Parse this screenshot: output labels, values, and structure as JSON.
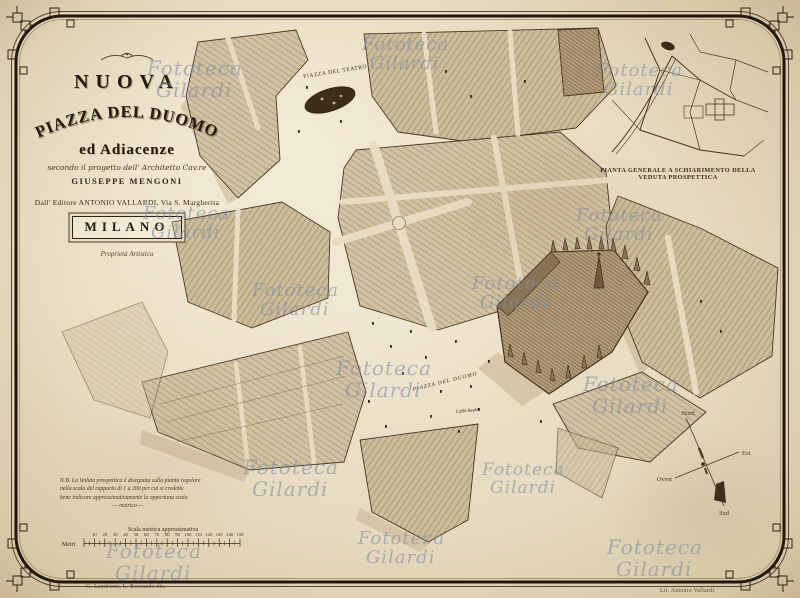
{
  "title_block": {
    "title_top": "NUOVA",
    "title_arc": "PIAZZA DEL DUOMO",
    "subtitle": "ed Adiacenze",
    "project_line": "secondo il progetto dell' Architetto Cav.re",
    "architect": "GIUSEPPE MENGONI",
    "publisher_line": "Dall' Editore ANTONIO VALLARDI, Via S. Margherita",
    "city": "MILANO",
    "rights": "Proprietà Artistica"
  },
  "inset": {
    "caption": "PIANTA GENERALE A SCHIARIMENTO DELLA VEDUTA PROSPETTICA"
  },
  "map_labels": {
    "piazza_teatro": "PIAZZA DEL TEATRO",
    "piazza_duomo": "PIAZZA DEL DUOMO",
    "caffe_reale": "Caffè Reale"
  },
  "note": {
    "lines": [
      "N.B. La Veduta prospettica è disegnata sulla pianta regolare",
      "nella scala del rapporto di 1 a 200 per cui si credette",
      "bene indicare approssimativamente la opportuna scala",
      "— metrica —"
    ]
  },
  "scale_bar": {
    "caption": "Scala metrica approssimativa",
    "unit": "Metri",
    "tick_labels": [
      "10",
      "20",
      "30",
      "40",
      "50",
      "60",
      "70",
      "80",
      "90",
      "100",
      "110",
      "120",
      "130",
      "140",
      "150"
    ]
  },
  "compass": {
    "n": "Nord",
    "e": "Est",
    "w": "Ovest",
    "s": "Sud"
  },
  "credits": {
    "drawn_by": "G. Landriani, L. Boccardo dis.",
    "lithographer": "Lit. Antonio Vallardi"
  },
  "watermark": {
    "line1": "Fototeca",
    "line2": "Gilardi",
    "color": "#7b8ea8",
    "positions": [
      {
        "x": 147,
        "y": 58,
        "fs": 20
      },
      {
        "x": 362,
        "y": 35,
        "fs": 18
      },
      {
        "x": 596,
        "y": 61,
        "fs": 18
      },
      {
        "x": 143,
        "y": 204,
        "fs": 18
      },
      {
        "x": 252,
        "y": 281,
        "fs": 18
      },
      {
        "x": 472,
        "y": 274,
        "fs": 18
      },
      {
        "x": 576,
        "y": 206,
        "fs": 18
      },
      {
        "x": 336,
        "y": 358,
        "fs": 20
      },
      {
        "x": 583,
        "y": 374,
        "fs": 20
      },
      {
        "x": 243,
        "y": 457,
        "fs": 20
      },
      {
        "x": 482,
        "y": 461,
        "fs": 17
      },
      {
        "x": 106,
        "y": 541,
        "fs": 20
      },
      {
        "x": 607,
        "y": 537,
        "fs": 20
      },
      {
        "x": 358,
        "y": 529,
        "fs": 18
      }
    ]
  },
  "colors": {
    "paper": "#e7dcc2",
    "ink": "#2f2315",
    "building": "#d0c2a2",
    "duomo": "#b29c78",
    "watermark": "#7b8ea8"
  }
}
